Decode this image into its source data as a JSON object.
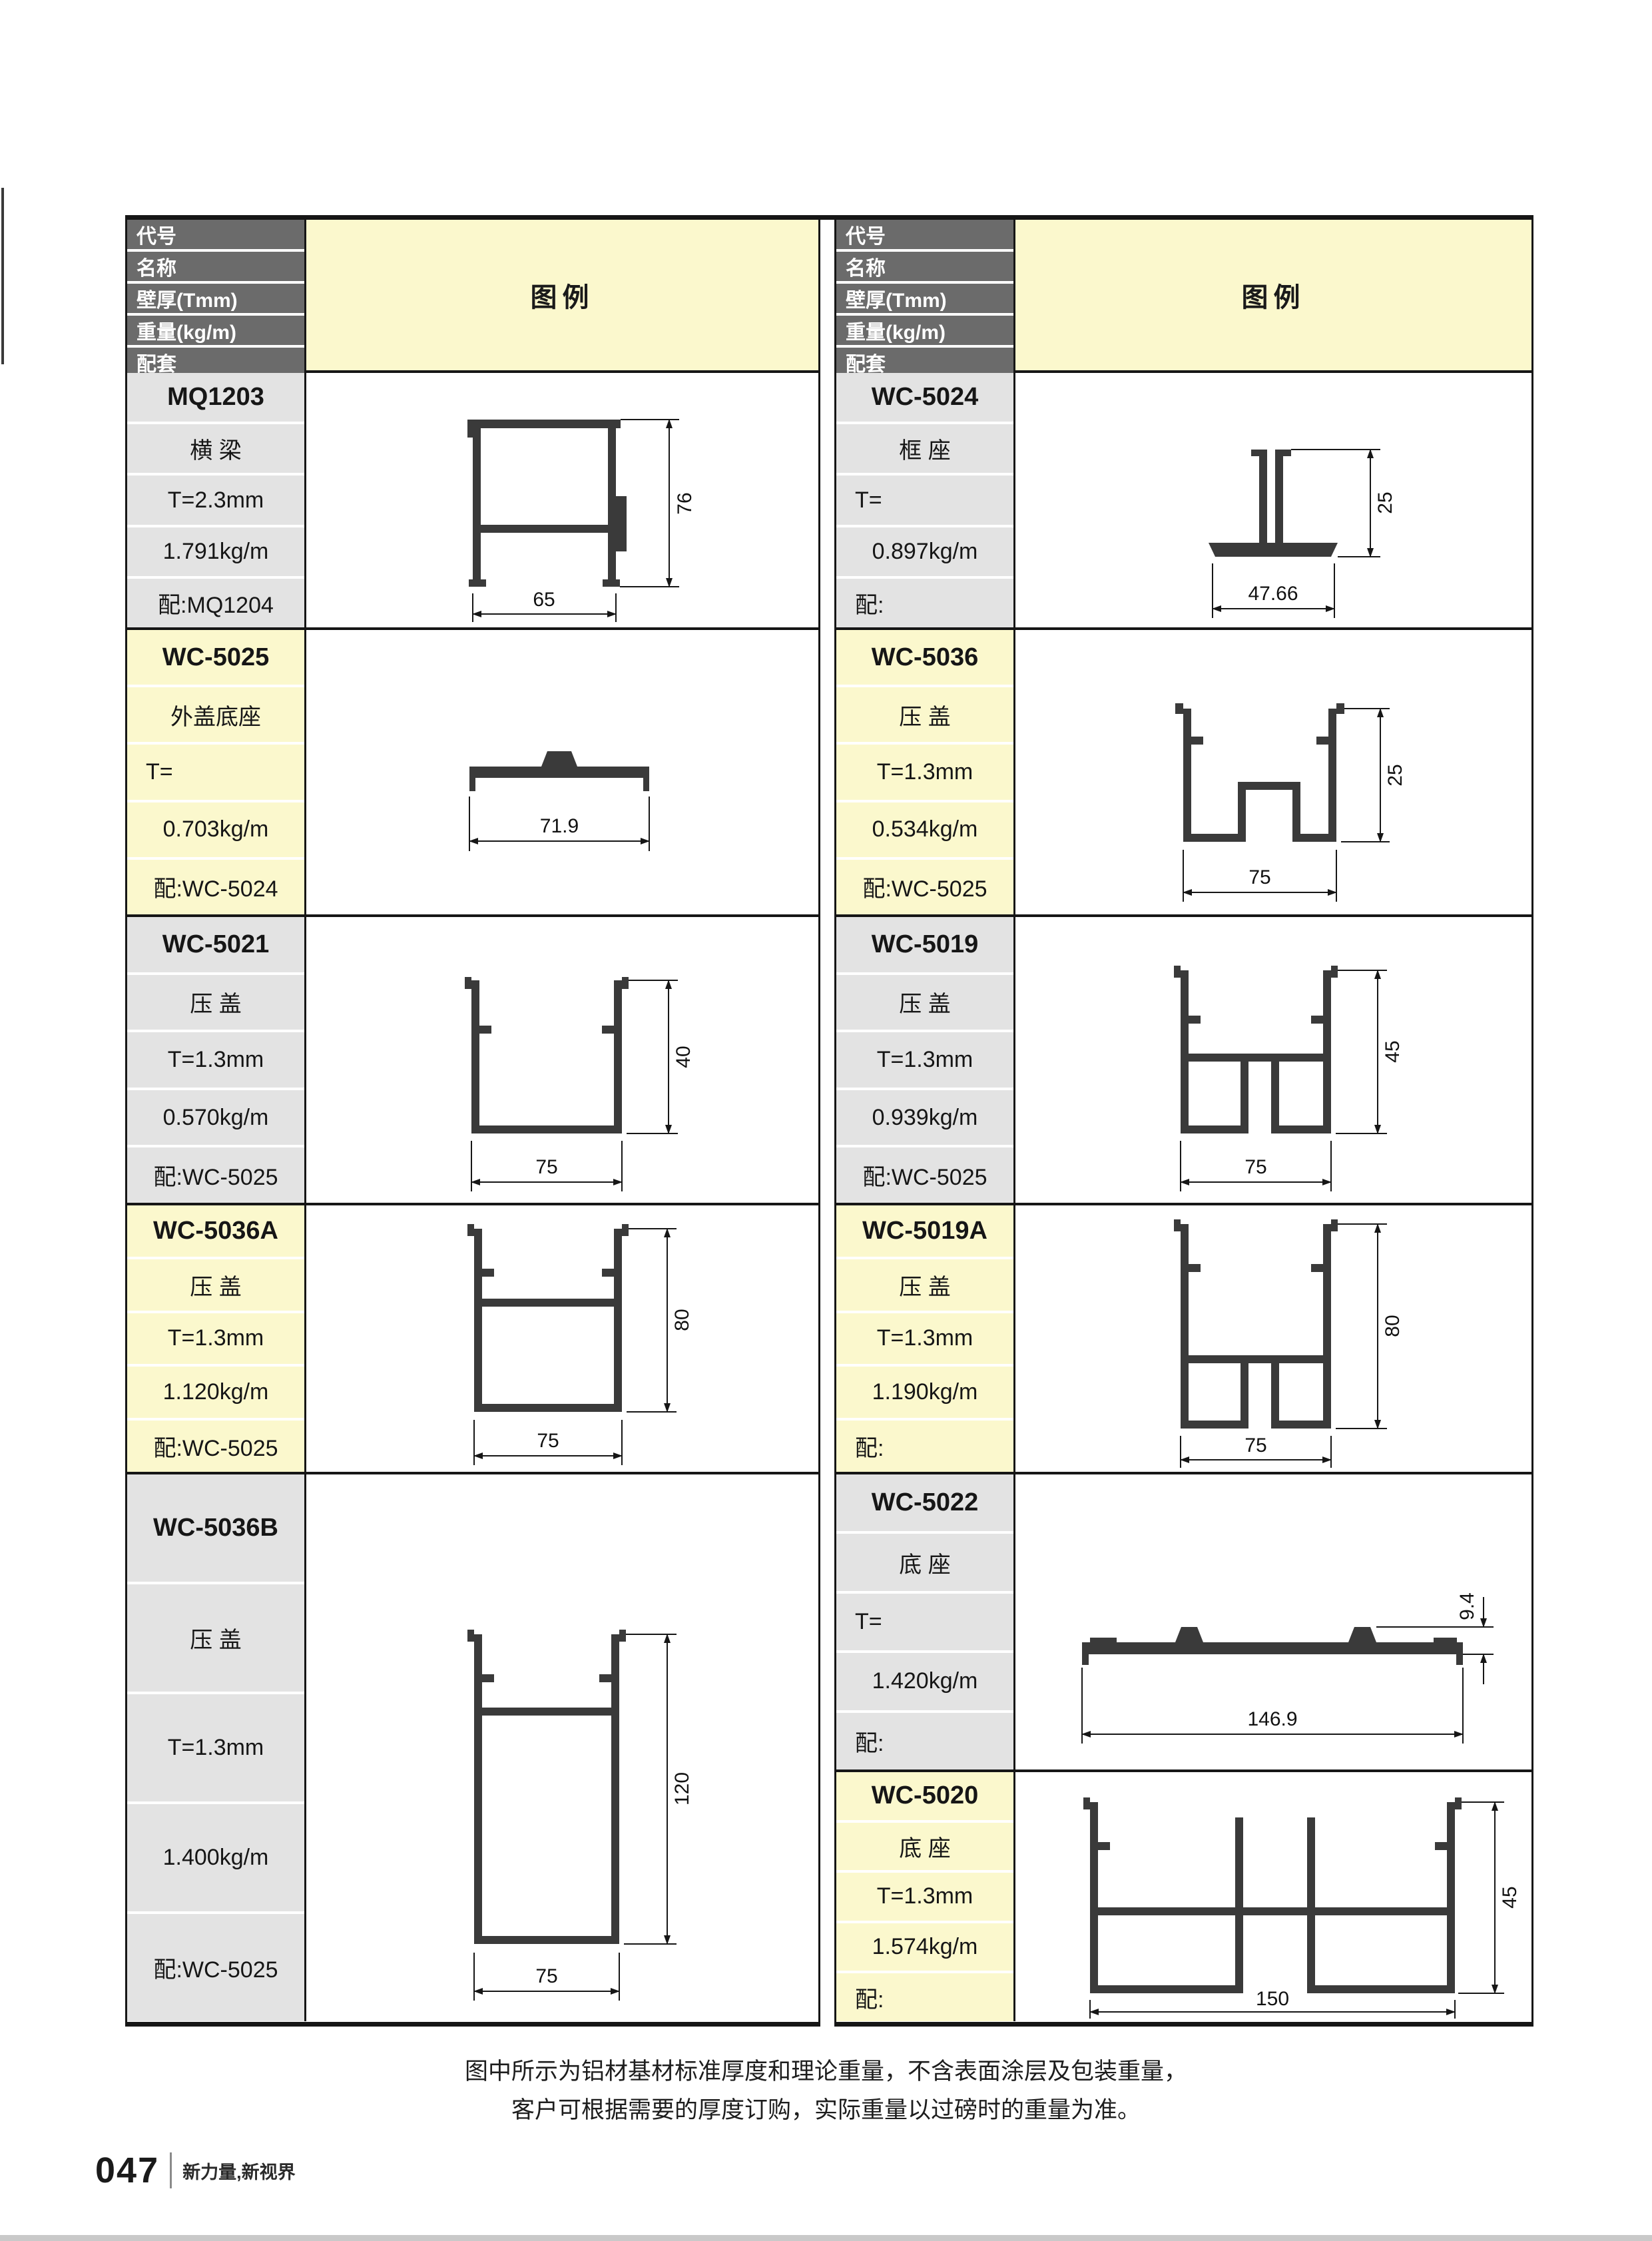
{
  "header_labels": {
    "code": "代号",
    "name": "名称",
    "thickness": "壁厚(Tmm)",
    "weight": "重量(kg/m)",
    "match": "配套",
    "legend": "图例"
  },
  "colors": {
    "accent_yellow": "#fbf8cd",
    "header_gray": "#6b6b6b",
    "cell_gray": "#e3e3e3",
    "line_black": "#161616",
    "profile_fill": "#3a3a3a",
    "footer_bar_gray": "#c9c9c9"
  },
  "left_rows": [
    {
      "code": "MQ1203",
      "name": "横 梁",
      "thickness": "T=2.3mm",
      "weight": "1.791kg/m",
      "match": "配:MQ1204",
      "dims": {
        "width": "65",
        "height": "76"
      }
    },
    {
      "code": "WC-5025",
      "name": "外盖底座",
      "thickness": "T=",
      "weight": "0.703kg/m",
      "match": "配:WC-5024",
      "dims": {
        "width": "71.9"
      }
    },
    {
      "code": "WC-5021",
      "name": "压 盖",
      "thickness": "T=1.3mm",
      "weight": "0.570kg/m",
      "match": "配:WC-5025",
      "dims": {
        "width": "75",
        "height": "40"
      }
    },
    {
      "code": "WC-5036A",
      "name": "压 盖",
      "thickness": "T=1.3mm",
      "weight": "1.120kg/m",
      "match": "配:WC-5025",
      "dims": {
        "width": "75",
        "height": "80"
      }
    },
    {
      "code": "WC-5036B",
      "name": "压 盖",
      "thickness": "T=1.3mm",
      "weight": "1.400kg/m",
      "match": "配:WC-5025",
      "dims": {
        "width": "75",
        "height": "120"
      }
    }
  ],
  "right_rows": [
    {
      "code": "WC-5024",
      "name": "框 座",
      "thickness": "T=",
      "weight": "0.897kg/m",
      "match": "配:",
      "dims": {
        "width": "47.66",
        "height": "25"
      }
    },
    {
      "code": "WC-5036",
      "name": "压 盖",
      "thickness": "T=1.3mm",
      "weight": "0.534kg/m",
      "match": "配:WC-5025",
      "dims": {
        "width": "75",
        "height": "25"
      }
    },
    {
      "code": "WC-5019",
      "name": "压 盖",
      "thickness": "T=1.3mm",
      "weight": "0.939kg/m",
      "match": "配:WC-5025",
      "dims": {
        "width": "75",
        "height": "45"
      }
    },
    {
      "code": "WC-5019A",
      "name": "压 盖",
      "thickness": "T=1.3mm",
      "weight": "1.190kg/m",
      "match": "配:",
      "dims": {
        "width": "75",
        "height": "80"
      }
    },
    {
      "code": "WC-5022",
      "name": "底 座",
      "thickness": "T=",
      "weight": "1.420kg/m",
      "match": "配:",
      "dims": {
        "width": "146.9",
        "height": "9.4"
      }
    },
    {
      "code": "WC-5020",
      "name": "底 座",
      "thickness": "T=1.3mm",
      "weight": "1.574kg/m",
      "match": "配:",
      "dims": {
        "width": "150",
        "height": "45"
      }
    }
  ],
  "note": {
    "line1": "图中所示为铝材基材标准厚度和理论重量，不含表面涂层及包装重量，",
    "line2": "客户可根据需要的厚度订购，实际重量以过磅时的重量为准。"
  },
  "footer": {
    "page_number": "047",
    "slogan": "新力量,新视界"
  }
}
